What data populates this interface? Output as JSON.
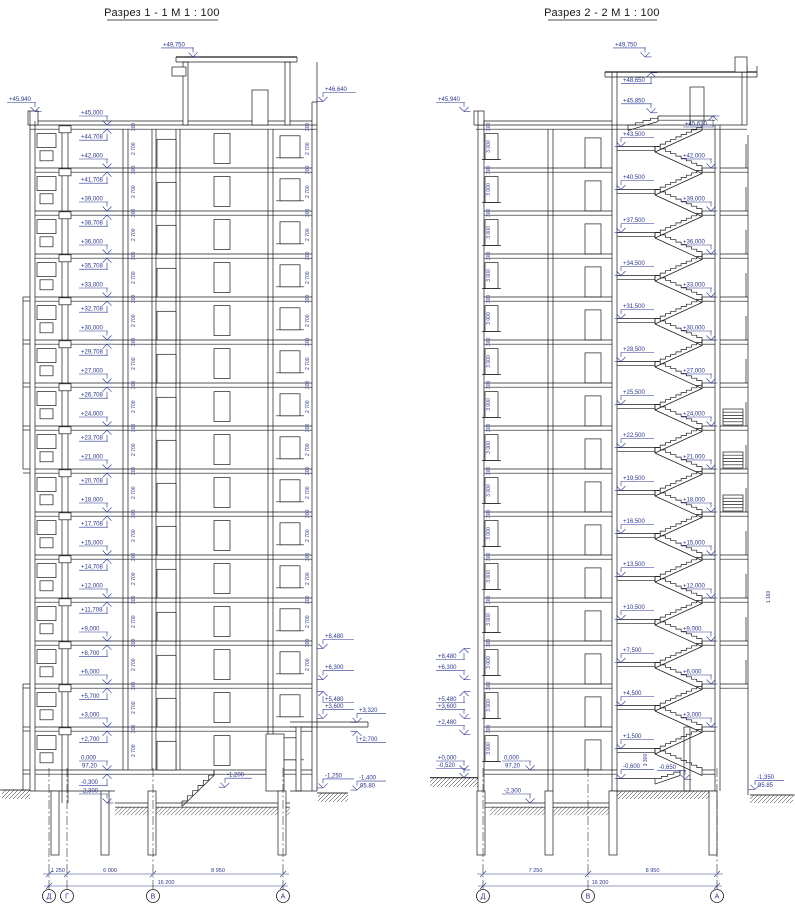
{
  "page": {
    "background": "#ffffff",
    "line_color": "#1b1b1b",
    "annotation_color": "#2a3590"
  },
  "sections": [
    {
      "title": "Разрез 1 - 1  М 1 : 100",
      "marks": {
        "top": {
          "t": "+49,750"
        },
        "left": {
          "t": "+45,940"
        },
        "right_top": {
          "t": "+46,640"
        },
        "ladder": [
          {
            "t": "+45,000"
          },
          {
            "t": "+44,708",
            "u": 1
          },
          {
            "t": "+42,000"
          },
          {
            "t": "+41,708",
            "u": 1
          },
          {
            "t": "+39,000"
          },
          {
            "t": "+38,708",
            "u": 1
          },
          {
            "t": "+36,000"
          },
          {
            "t": "+35,708",
            "u": 1
          },
          {
            "t": "+33,000"
          },
          {
            "t": "+32,708",
            "u": 1
          },
          {
            "t": "+30,000"
          },
          {
            "t": "+29,708",
            "u": 1
          },
          {
            "t": "+27,000"
          },
          {
            "t": "+26,708",
            "u": 1
          },
          {
            "t": "+24,000"
          },
          {
            "t": "+23,708",
            "u": 1
          },
          {
            "t": "+21,000"
          },
          {
            "t": "+20,708",
            "u": 1
          },
          {
            "t": "+18,000"
          },
          {
            "t": "+17,708",
            "u": 1
          },
          {
            "t": "+15,000"
          },
          {
            "t": "+14,708",
            "u": 1
          },
          {
            "t": "+12,000"
          },
          {
            "t": "+11,708",
            "u": 1
          },
          {
            "t": "+9,000"
          },
          {
            "t": "+8,700",
            "u": 1
          },
          {
            "t": "+6,000"
          },
          {
            "t": "+5,700",
            "u": 1
          },
          {
            "t": "+3,000"
          },
          {
            "t": "+2,700",
            "u": 1
          },
          {
            "t": "0,000",
            "sub": "97,20"
          },
          {
            "t": "-0,300",
            "u": 1
          },
          {
            "t": "-2,300"
          }
        ],
        "right_col_a": [
          {
            "t": "+8,480"
          },
          {
            "t": "+6,300"
          },
          {
            "t": "+5,480",
            "u": 1
          },
          {
            "t": "+3,600"
          },
          {
            "t": "-1,250"
          }
        ],
        "right_col_b": [
          {
            "t": "+3,320"
          },
          {
            "t": "+2,700",
            "u": 1
          },
          {
            "t": "-1,400",
            "sub": "95.80"
          }
        ],
        "entrance": {
          "t": "-1,200"
        }
      },
      "dims": {
        "storey": "2 700",
        "slab": "300"
      },
      "axes": {
        "labels": [
          "Д",
          "Г",
          "В",
          "А"
        ],
        "dims": [
          "1 250",
          "6 000",
          "8 950"
        ],
        "total": "16 200"
      }
    },
    {
      "title": "Разрез 2 - 2  М 1 : 100",
      "marks": {
        "top": {
          "t": "+49,750"
        },
        "left": {
          "t": "+45,940"
        },
        "machine": [
          {
            "t": "+48,650",
            "u": 1
          },
          {
            "t": "+45,850"
          },
          {
            "t": "+45,630",
            "u": 1
          }
        ],
        "left_col": [
          {
            "t": "+8,480",
            "u": 1
          },
          {
            "t": "+6,300"
          },
          {
            "t": "+5,480",
            "u": 1
          },
          {
            "t": "+3,600"
          },
          {
            "t": "+2,480"
          },
          {
            "t": "+0,000"
          },
          {
            "t": "-0,520"
          }
        ],
        "landings": [
          "+43,500",
          "+40,500",
          "+37,500",
          "+34,500",
          "+31,500",
          "+28,500",
          "+25,500",
          "+22,500",
          "+19,500",
          "+16,500",
          "+13,500",
          "+10,500",
          "+7,500",
          "+4,500",
          "+1,500",
          "-0,600"
        ],
        "floors": [
          "+42,000",
          "+39,000",
          "+36,000",
          "+33,000",
          "+30,000",
          "+27,000",
          "+24,000",
          "+21,000",
          "+18,000",
          "+15,000",
          "+12,000",
          "+9,000",
          "+6,000",
          "+3,000"
        ],
        "interior": [
          {
            "t": "0,000",
            "sub": "97,20"
          },
          {
            "t": "-2,300"
          }
        ],
        "bottom_right": [
          {
            "t": "-0,650"
          },
          {
            "t": "-1,350",
            "sub": "95.85"
          }
        ]
      },
      "dims": {
        "storey": "3 000",
        "slab": "300",
        "stair_flight": "3 300",
        "balcony": "1 160"
      },
      "axes": {
        "labels": [
          "Д",
          "В",
          "А"
        ],
        "dims": [
          "7 250",
          "8 950"
        ],
        "total": "16 200"
      }
    }
  ]
}
